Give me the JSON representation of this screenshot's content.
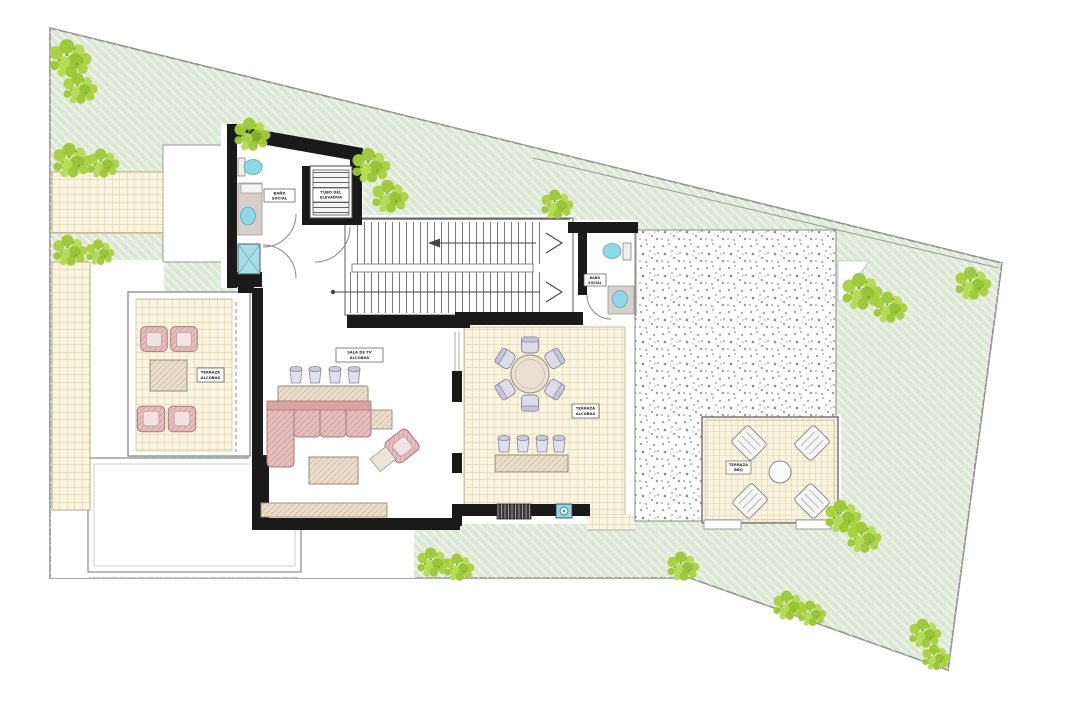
{
  "plan": {
    "type": "architectural floor plan - upper level with roof terraces and garden",
    "labels": {
      "elevator": {
        "line1": "TUBO DEL",
        "line2": "ELEVADOR"
      },
      "bath_upper": {
        "line1": "BAÑO",
        "line2": "SOCIAL"
      },
      "tv_room": {
        "line1": "SALA DE TV",
        "line2": "ALCOBAS"
      },
      "terrace_left": {
        "line1": "TERRAZA",
        "line2": "ALCOBAS"
      },
      "terrace_dining": {
        "line1": "TERRAZA",
        "line2": "ALCOBAS"
      },
      "bath_right": {
        "line1": "BAÑO",
        "line2": "SOCIAL"
      },
      "pergola": {
        "line1": "TERRAZA",
        "line2": "BBQ"
      }
    },
    "features": [
      "irregular lawn plot with diagonal hatch and shrub clusters",
      "double-line property boundary",
      "U-shaped staircase with direction arrows",
      "elevator shaft with hatched machinery",
      "upper bathroom with toilet, vanity, washbasin and shower",
      "lower-right bathroom with toilet and washbasin",
      "TV lounge with L-shaped sofa, bar counter and four stools",
      "coffee table, side tables and rotated accent armchair",
      "media console along bottom wall",
      "left roof terrace with four armchairs and table",
      "dining terrace with round table and six chairs",
      "high table with four stools",
      "built-in grill and sink in bottom wall",
      "gravel patio",
      "pergola lounge with four recliners and round table",
      "paved tile walkways",
      "white lower-roof footprints"
    ],
    "palette": {
      "lawn": "#dfe9d8",
      "lawn_hatch": "#ffffff",
      "shrub": "#a6d13c",
      "shrub_dark": "#7aa51f",
      "tile": "#fbf5df",
      "tile_grid": "#d8c7a0",
      "gravel": "#fdfdfd",
      "gravel_speck": "#8a8a8a",
      "wall": "#1a1a1a",
      "partition": "#777777",
      "sofa_pink": "#e6bebe",
      "sofa_trim": "#a97878",
      "wood": "#e9ddcb",
      "wood_trim": "#9a8a76",
      "seat_gray": "#dcdce9",
      "fixture_teal": "#8fd8e8",
      "lounge_white": "#f6f6f6"
    }
  }
}
